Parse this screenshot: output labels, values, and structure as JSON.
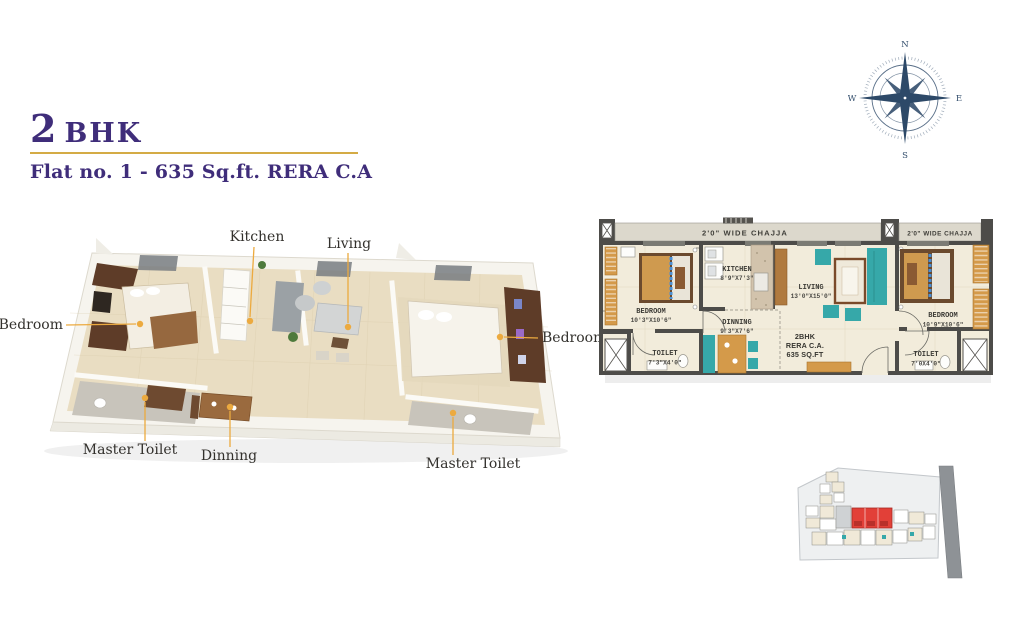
{
  "header": {
    "title_number": "2",
    "title_suffix": "BHK",
    "subtitle": "Flat no. 1 - 635 Sq.ft. RERA C.A"
  },
  "compass": {
    "north": "N",
    "east": "E",
    "south": "S",
    "west": "W"
  },
  "render3d": {
    "labels": {
      "kitchen": "Kitchen",
      "living": "Living",
      "bedroom_left": "Bedroom",
      "bedroom_right": "Bedroom",
      "master_toilet_left": "Master Toilet",
      "master_toilet_right": "Master Toilet",
      "dinning": "Dinning"
    }
  },
  "plan2d": {
    "chajja_left": "2'0\" WIDE CHAJJA",
    "chajja_right": "2'0\" WIDE CHAJJA",
    "rooms": {
      "bedroom_left": {
        "name": "BEDROOM",
        "dim": "10'3\"X10'6\""
      },
      "kitchen": {
        "name": "KITCHEN",
        "dim": "8'9\"X7'3\""
      },
      "dinning": {
        "name": "DINNING",
        "dim": "9'3\"X7'6\""
      },
      "living": {
        "name": "LIVING",
        "dim": "13'0\"X15'0\""
      },
      "bedroom_right": {
        "name": "BEDROOM",
        "dim": "10'9\"X10'6\""
      },
      "toilet_left": {
        "name": "TOILET",
        "dim": "7'3\"X4'0\""
      },
      "toilet_right": {
        "name": "TOILET",
        "dim": "7'0X4'0\""
      }
    },
    "unit_info": {
      "line1": "2BHK",
      "line2": "RERA C.A.",
      "line3": "635 SQ.FT"
    }
  },
  "colors": {
    "title_purple": "#3f2d7a",
    "accent_gold": "#d4ab45",
    "leader_gold": "#ecaa3f",
    "wall_dark": "#4d4c49",
    "floor_cream": "#f2ecdb",
    "teal": "#36a8a9",
    "wood": "#d49a4a",
    "compass_navy": "#1c3a5c",
    "site_red": "#e24038"
  }
}
